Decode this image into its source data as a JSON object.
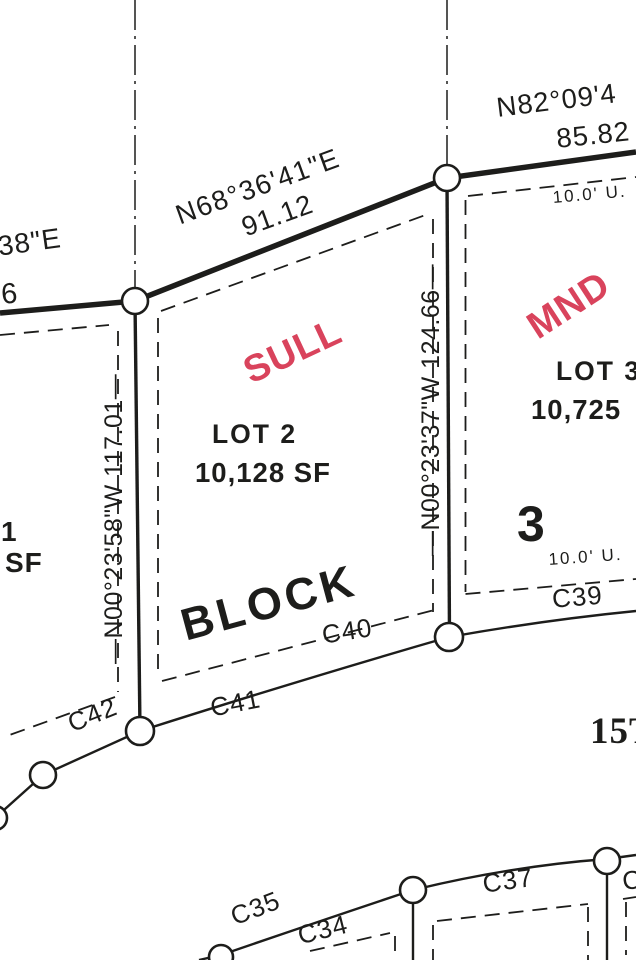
{
  "colors": {
    "ink": "#1d1d1b",
    "red": "#d9435c",
    "paper": "#ffffff"
  },
  "boundary": {
    "left_bearing_fragment": "38\"E",
    "left_distance_fragment": "6",
    "seg1_bearing": "N68°36'41\"E",
    "seg1_distance": "91.12",
    "seg2_bearing_fragment": "N82°09'4",
    "seg2_distance_fragment": "85.82"
  },
  "lot_lines": {
    "lot1_lot2": "—N00°23'58\"W 117.01—",
    "lot2_lot3": "—N00°23'37\"W 124.66—"
  },
  "lots": {
    "lot1": {
      "number_fragment": "1",
      "area_fragment": "SF"
    },
    "lot2": {
      "label": "LOT 2",
      "area": "10,128 SF",
      "owner_tag": "SULL"
    },
    "lot3": {
      "label": "LOT 3",
      "area_fragment": "10,725",
      "owner_tag": "MND"
    }
  },
  "block": {
    "word": "BLOCK",
    "number": "3"
  },
  "easements": {
    "upper": "10.0' U.",
    "lower": "10.0' U."
  },
  "curve_labels": {
    "c34": "C34",
    "c35": "C35",
    "c37": "C37",
    "c38_fragment": "C38",
    "c39": "C39",
    "c40": "C40",
    "c41": "C41",
    "c42": "C42"
  },
  "street": {
    "name_fragment": "15TH"
  }
}
